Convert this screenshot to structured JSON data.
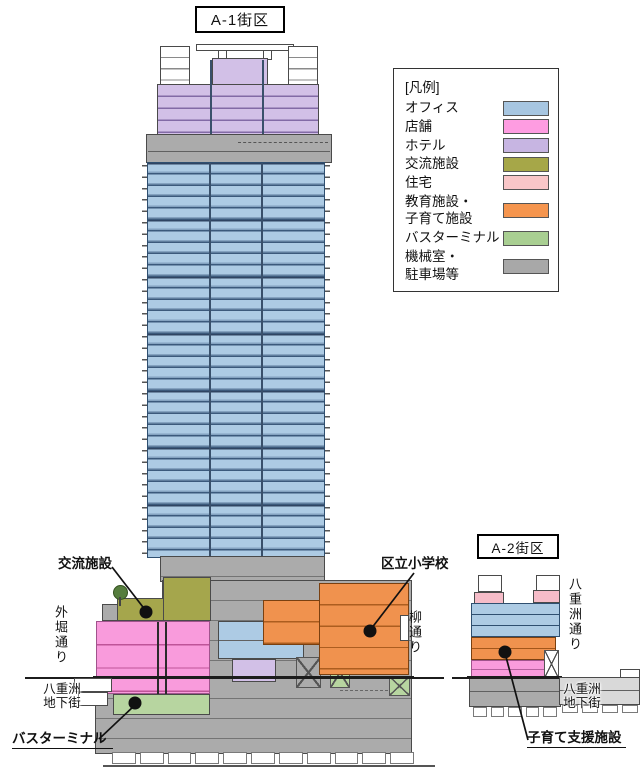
{
  "diagram": {
    "a1_label": "A-1街区",
    "a2_label": "A-2街区",
    "annotations": {
      "exchange_facility": "交流施設",
      "ward_elementary_school": "区立小学校",
      "bus_terminal": "バスターミナル",
      "childcare_support_facility": "子育て支援施設"
    },
    "streets": {
      "sotobori_dori": "外堀通り",
      "yanagi_dori": "柳通り",
      "yaesu_dori": "八重洲通り",
      "yaesu_underground_left": "八重洲\n地下街",
      "yaesu_underground_right": "八重洲\n地下街"
    }
  },
  "legend": {
    "title": "[凡例]",
    "items": [
      {
        "label": "オフィス",
        "color": "#a7c6e1"
      },
      {
        "label": "店舗",
        "color": "#fe9ce1"
      },
      {
        "label": "ホテル",
        "color": "#c7b5e2"
      },
      {
        "label": "交流施設",
        "color": "#a6a748"
      },
      {
        "label": "住宅",
        "color": "#f9c6c8"
      },
      {
        "label": "教育施設・\n子育て施設",
        "color": "#f5954e"
      },
      {
        "label": "バスターミナル",
        "color": "#a9cf92"
      },
      {
        "label": "機械室・\n駐車場等",
        "color": "#a8a8a8"
      }
    ]
  }
}
